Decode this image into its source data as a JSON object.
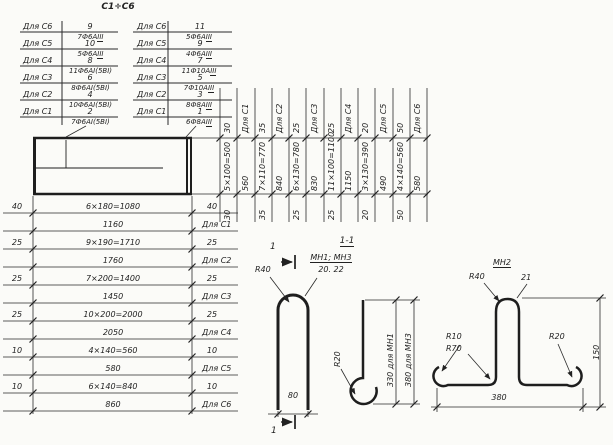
{
  "title": "С1÷С6",
  "section_title": "1-1",
  "cut_label": "1",
  "left_table": {
    "rows": [
      {
        "label": "Для С6",
        "pos": "9",
        "spec": "7Ф6А",
        "cls3": "III"
      },
      {
        "label": "Для С5",
        "pos": "10",
        "spec": "5Ф6А",
        "cls3": "III"
      },
      {
        "label": "Для С4",
        "pos": "8",
        "spec": "11Ф6АI(5ВI)"
      },
      {
        "label": "Для С3",
        "pos": "6",
        "spec": "8Ф6АI(5ВI)"
      },
      {
        "label": "Для С2",
        "pos": "4",
        "spec": "10Ф6АI(5ВI)"
      },
      {
        "label": "Для С1",
        "pos": "2",
        "spec": "7Ф6АI(5ВI)"
      }
    ]
  },
  "right_table": {
    "rows": [
      {
        "label": "Для С6",
        "pos": "11",
        "spec": "5Ф6А",
        "cls3": "III"
      },
      {
        "label": "Для С5",
        "pos": "9",
        "spec": "4Ф6А",
        "cls3": "III"
      },
      {
        "label": "Для С4",
        "pos": "7",
        "spec": "11Ф10А",
        "cls3": "III"
      },
      {
        "label": "Для С3",
        "pos": "5",
        "spec": "7Ф10А",
        "cls3": "III"
      },
      {
        "label": "Для С2",
        "pos": "3",
        "spec": "8Ф8А",
        "cls3": "III"
      },
      {
        "label": "Для С1",
        "pos": "1",
        "spec": "6Ф8А",
        "cls3": "III"
      }
    ]
  },
  "top_dims": {
    "above": [
      "30",
      "Для С1",
      "35",
      "Для С2",
      "25",
      "Для С3",
      "25",
      "Для С4",
      "20",
      "Для С5",
      "50",
      "Для С6"
    ],
    "mid": [
      "5×100=500",
      "560",
      "7×110=770",
      "840",
      "6×130=780",
      "830",
      "11×100=1100",
      "1150",
      "3×130=390",
      "490",
      "4×140=560",
      "580"
    ],
    "below": [
      "30",
      "35",
      "25",
      "25",
      "20",
      "50"
    ]
  },
  "left_dims": {
    "rows": [
      {
        "l": "40",
        "m": "6×180=1080",
        "r": "40"
      },
      {
        "m": "1160",
        "label": "Для С1"
      },
      {
        "l": "25",
        "m": "9×190=1710",
        "r": "25"
      },
      {
        "m": "1760",
        "label": "Для С2"
      },
      {
        "l": "25",
        "m": "7×200=1400",
        "r": "25"
      },
      {
        "m": "1450",
        "label": "Для С3"
      },
      {
        "l": "25",
        "m": "10×200=2000",
        "r": "25"
      },
      {
        "m": "2050",
        "label": "Для С4"
      },
      {
        "l": "10",
        "m": "4×140=560",
        "r": "10"
      },
      {
        "m": "580",
        "label": "Для С5"
      },
      {
        "l": "10",
        "m": "6×140=840",
        "r": "10"
      },
      {
        "m": "860",
        "label": "Для С6"
      }
    ]
  },
  "section": {
    "hairpin": {
      "radius": "R40",
      "marks": "МН1; МН3",
      "positions": "20. 22",
      "width": "80"
    },
    "hook": {
      "radius": "R20",
      "dim_mn1": "330 для МН1",
      "dim_mn3": "380 для МН3"
    },
    "hat": {
      "mark": "МН2",
      "pos": "21",
      "r_top": "R40",
      "r_end_left": "R10",
      "r_corner_left": "R70",
      "r_end_right": "R20",
      "height": "150",
      "width": "380"
    }
  },
  "colors": {
    "ink": "#222222",
    "paper": "#fbfbf8"
  }
}
